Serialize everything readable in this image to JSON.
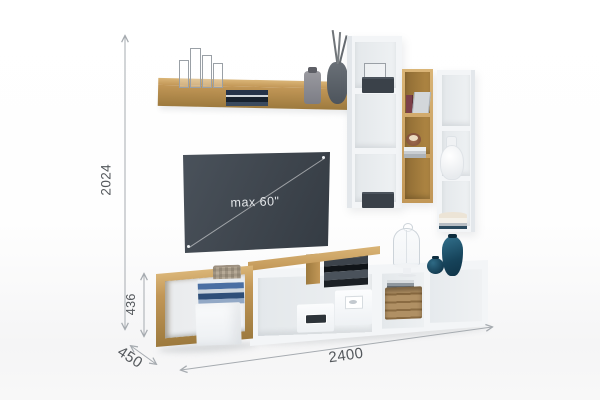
{
  "annotations": {
    "total_height": "2024",
    "stand_height": "436",
    "depth": "450",
    "total_width": "2400"
  },
  "tv": {
    "max_size_label": "max 60\""
  },
  "colors": {
    "wood": "#c29757",
    "wood_light": "#dab577",
    "wood_dark": "#9d7a3e",
    "wood_interior": "#b18844",
    "white_face": "#f3f5f7",
    "white_side": "#e3e7eb",
    "tv_dark": "#3e454d",
    "dim_line": "#a6abb0",
    "dim_text": "#54585c",
    "teal_dark": "#16435a",
    "teal_light": "#2e6a85",
    "box_dark": "#3a4149"
  },
  "objects": [
    "wall shelf (oak) with wire candleholders, books, glass jar, branch vase",
    "tall white wall cabinet with dark storage boxes",
    "oak wall cabinet with books and candle",
    "white wall cabinet with white vase and bowls",
    "tv screen max 60 inch",
    "tv stand with oak and white open compartments",
    "white storage boxes",
    "oak crate with magazines",
    "glass cloche on stand",
    "teal vases",
    "woven basket and book stack"
  ]
}
